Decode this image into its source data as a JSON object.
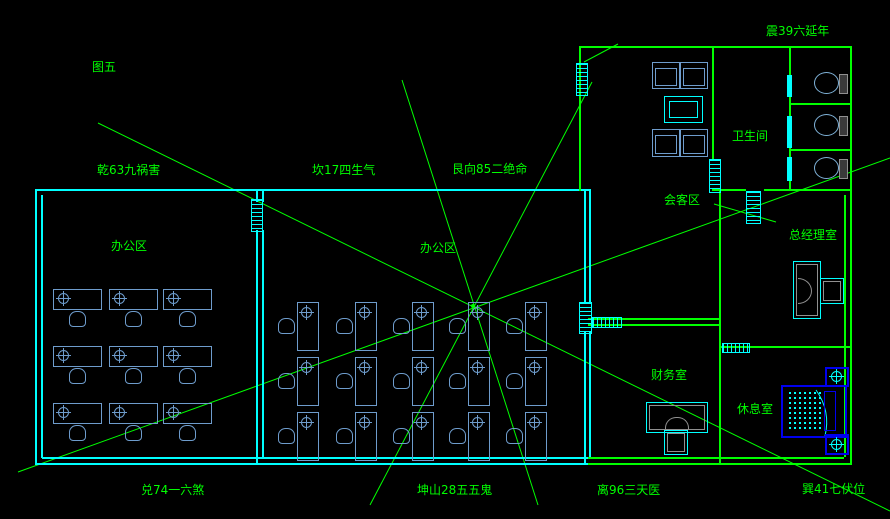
{
  "figure_label": "图五",
  "compass_annotations": [
    {
      "id": "zhen",
      "text": "震39六延年"
    },
    {
      "id": "qian",
      "text": "乾63九祸害"
    },
    {
      "id": "kan",
      "text": "坎17四生气"
    },
    {
      "id": "gen",
      "text": "艮向85二绝命"
    },
    {
      "id": "dui",
      "text": "兑74一六煞"
    },
    {
      "id": "kun",
      "text": "坤山28五五鬼"
    },
    {
      "id": "li",
      "text": "离96三天医"
    },
    {
      "id": "xun",
      "text": "巽41七伏位"
    }
  ],
  "rooms": [
    {
      "id": "office-left",
      "name": "办公区"
    },
    {
      "id": "office-middle",
      "name": "办公区"
    },
    {
      "id": "meeting-area",
      "name": "会客区"
    },
    {
      "id": "restroom",
      "name": "卫生间"
    },
    {
      "id": "gm-office",
      "name": "总经理室"
    },
    {
      "id": "finance-office",
      "name": "财务室"
    },
    {
      "id": "lounge",
      "name": "休息室"
    }
  ],
  "colors": {
    "line_green": "#00ff00",
    "wall_cyan": "#00ffff",
    "furniture_blue": "#6e9ccc",
    "shower_blue": "#0000ff",
    "desk_gray": "#909090",
    "background": "#000000"
  }
}
